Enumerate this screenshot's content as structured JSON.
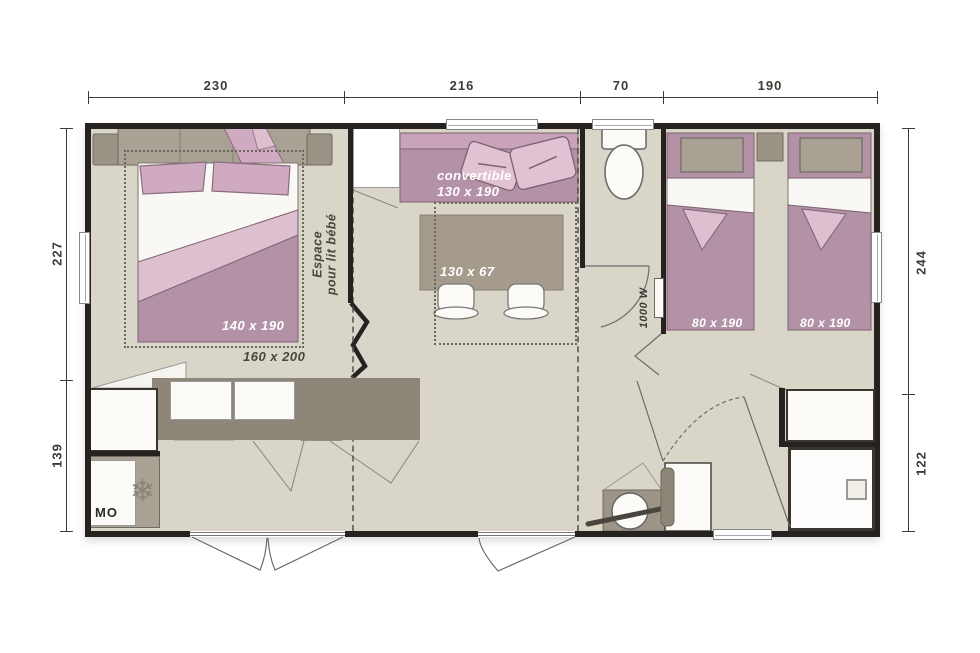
{
  "dimensions": {
    "top": [
      "230",
      "216",
      "70",
      "190"
    ],
    "left": [
      "227",
      "139"
    ],
    "right": [
      "244",
      "122"
    ]
  },
  "labels": {
    "master_bed": "140 x 190",
    "master_room": "160 x 200",
    "baby_space_l1": "Espace",
    "baby_space_l2": "pour lit bébé",
    "sofa_l1": "convertible",
    "sofa_l2": "130 x 190",
    "table": "130 x 67",
    "twin_bed_1": "80 x 190",
    "twin_bed_2": "80 x 190",
    "heater": "1000 W",
    "microwave": "MO"
  },
  "icons": {
    "snowflake": "❄"
  },
  "colors": {
    "wall": "#262220",
    "floor": "#d9d5c8",
    "taupe": "#a9a193",
    "taupe_dark": "#8e8779",
    "taupe_mid": "#9b9385",
    "mauve": "#b392a7",
    "pink": "#cfaac1",
    "pink_light": "#dcc0d0",
    "pink_pale": "#e0c2d3",
    "line": "#6f6a5f",
    "dim_text": "#3f3a35",
    "fixture": "#fcfbf8"
  }
}
